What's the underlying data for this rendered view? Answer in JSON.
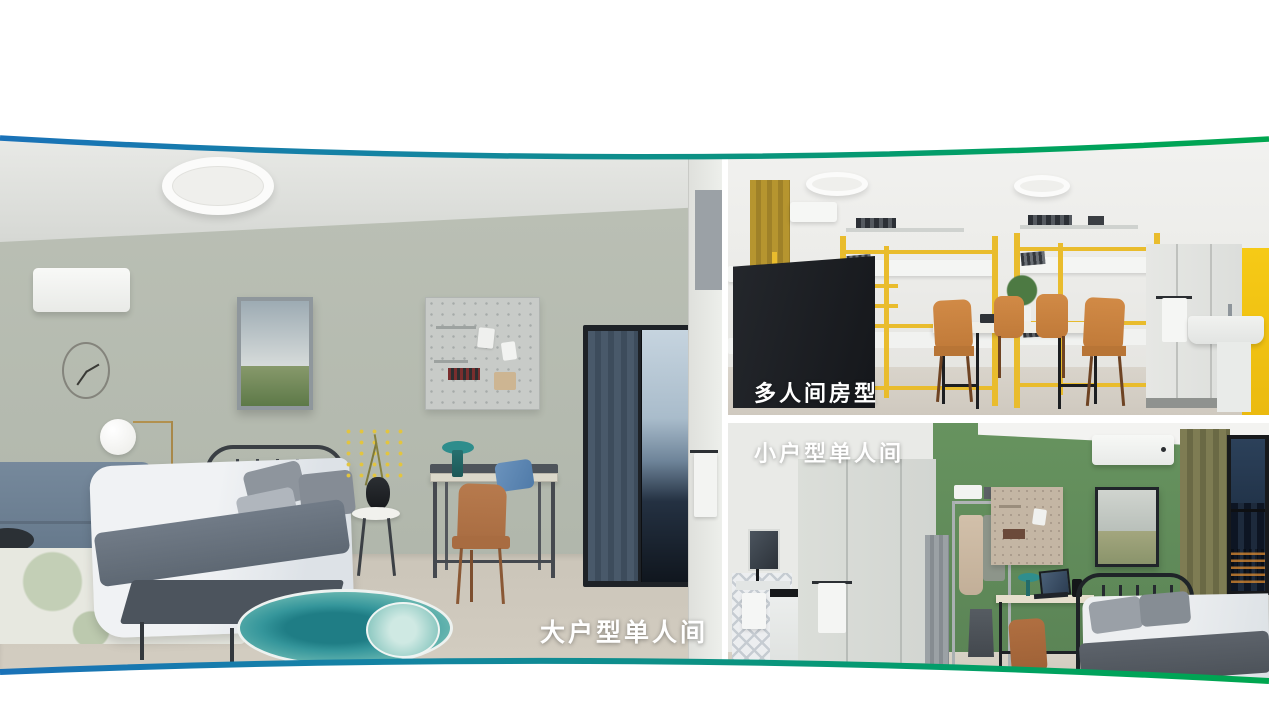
{
  "header": {
    "title": "乐璟灵珑系列产品"
  },
  "photos": {
    "large_single": {
      "label": "大户型单人间"
    },
    "multi_person": {
      "label": "多人间房型"
    },
    "small_single": {
      "label": "小户型单人间"
    }
  },
  "colors": {
    "curve_gradient_left_blue": "#1a72b8",
    "curve_gradient_mid_teal": "#0c9184",
    "curve_gradient_right_green": "#00a64f",
    "title_gradient_start": "#4ba3c3",
    "title_gradient_end": "#16a24d",
    "bunk_bed_yellow": "#e9bc2d",
    "accent_wall_green": "#67935f",
    "rug_teal": "#35969b"
  }
}
